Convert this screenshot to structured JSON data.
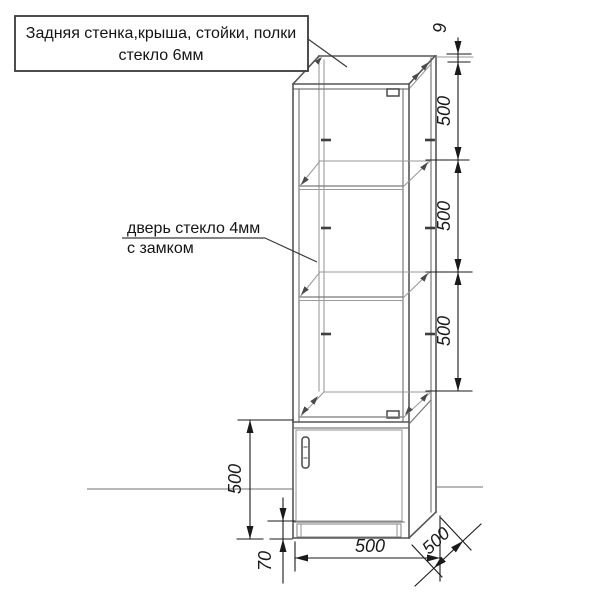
{
  "drawing": {
    "type": "furniture-technical-drawing",
    "subject": "glass display cabinet (vitrine) with base cupboard"
  },
  "callouts": {
    "top_glass": {
      "line1": "Задняя стенка,крыша, стойки, полки",
      "line2": "стекло 6мм"
    },
    "door_glass": {
      "line1": "дверь стекло 4мм",
      "line2": "с замком"
    }
  },
  "dimensions": {
    "top_profile": "9",
    "shelf_section_1": "500",
    "shelf_section_2": "500",
    "shelf_section_3": "500",
    "base_height": "500",
    "plinth_height": "70",
    "width": "500",
    "depth": "500"
  },
  "colors": {
    "background": "#ffffff",
    "cabinet_line": "#565656",
    "dimension_line": "#1a1a1a",
    "text": "#141414"
  }
}
